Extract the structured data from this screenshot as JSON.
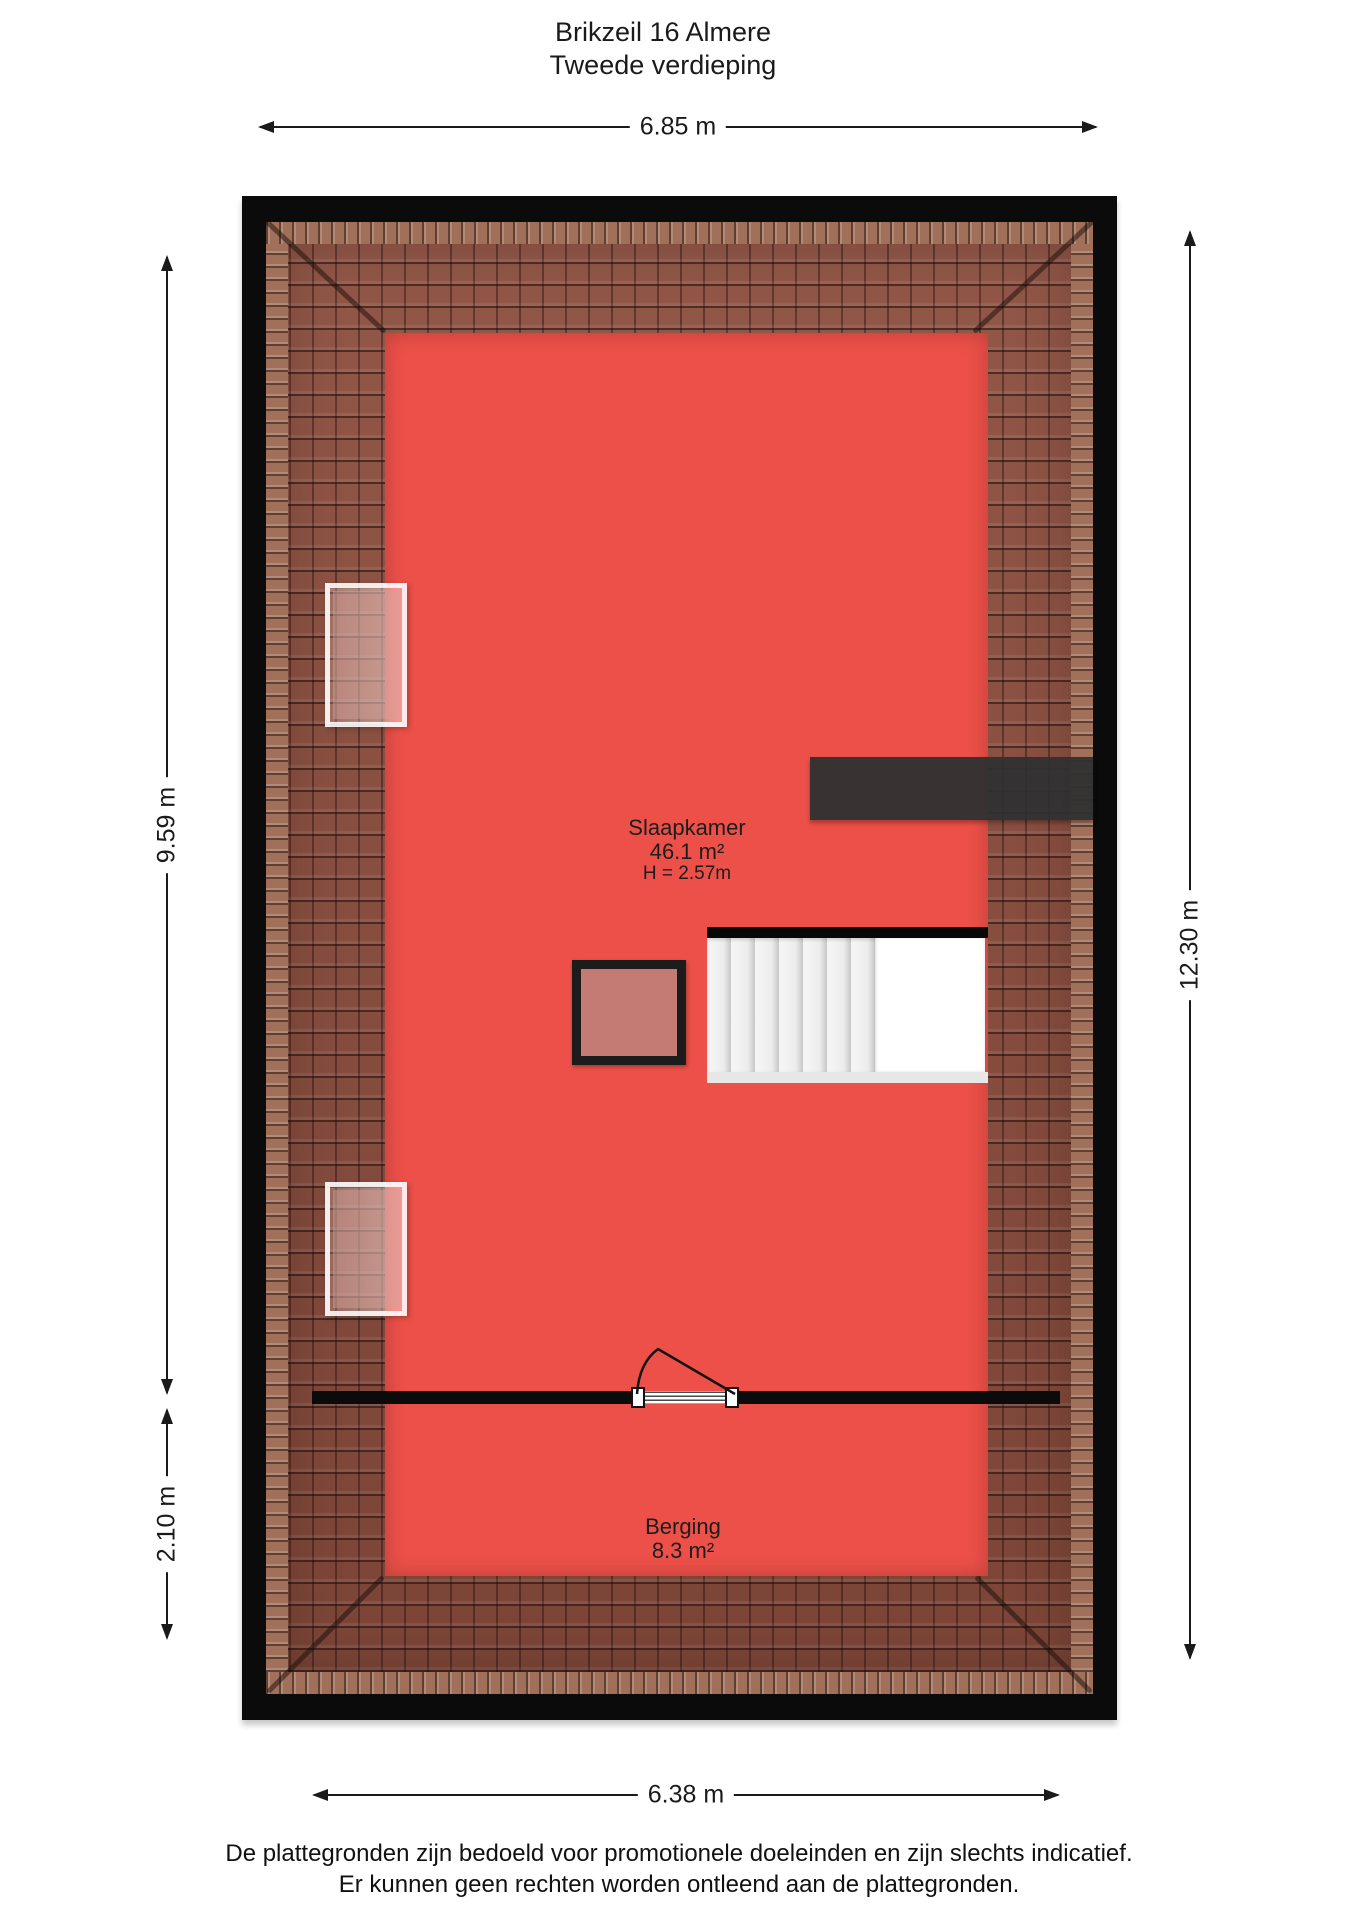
{
  "title": {
    "line1": "Brikzeil 16 Almere",
    "line2": "Tweede verdieping"
  },
  "dimensions": {
    "top": "6.85 m",
    "left_upper": "9.59 m",
    "left_lower": "2.10 m",
    "right": "12.30 m",
    "bottom": "6.38 m"
  },
  "rooms": [
    {
      "name": "Slaapkamer",
      "area": "46.1 m²",
      "ceiling_height": "H = 2.57m"
    },
    {
      "name": "Berging",
      "area": "8.3 m²"
    }
  ],
  "footer": {
    "line1": "De plattegronden zijn bedoeld voor promotionele doeleinden en zijn slechts indicatief.",
    "line2": "Er kunnen geen rechten worden ontleend aan de plattegronden."
  },
  "colors": {
    "floor_red": "#EC5048",
    "roof_tile": "#884F41",
    "ridge_tile": "#A1705A",
    "wall_black": "#0B0B0B",
    "dark_box": "#2F3032",
    "roof_hatch_fill": "#C47B74",
    "stair_tread": "#EDEDED"
  }
}
